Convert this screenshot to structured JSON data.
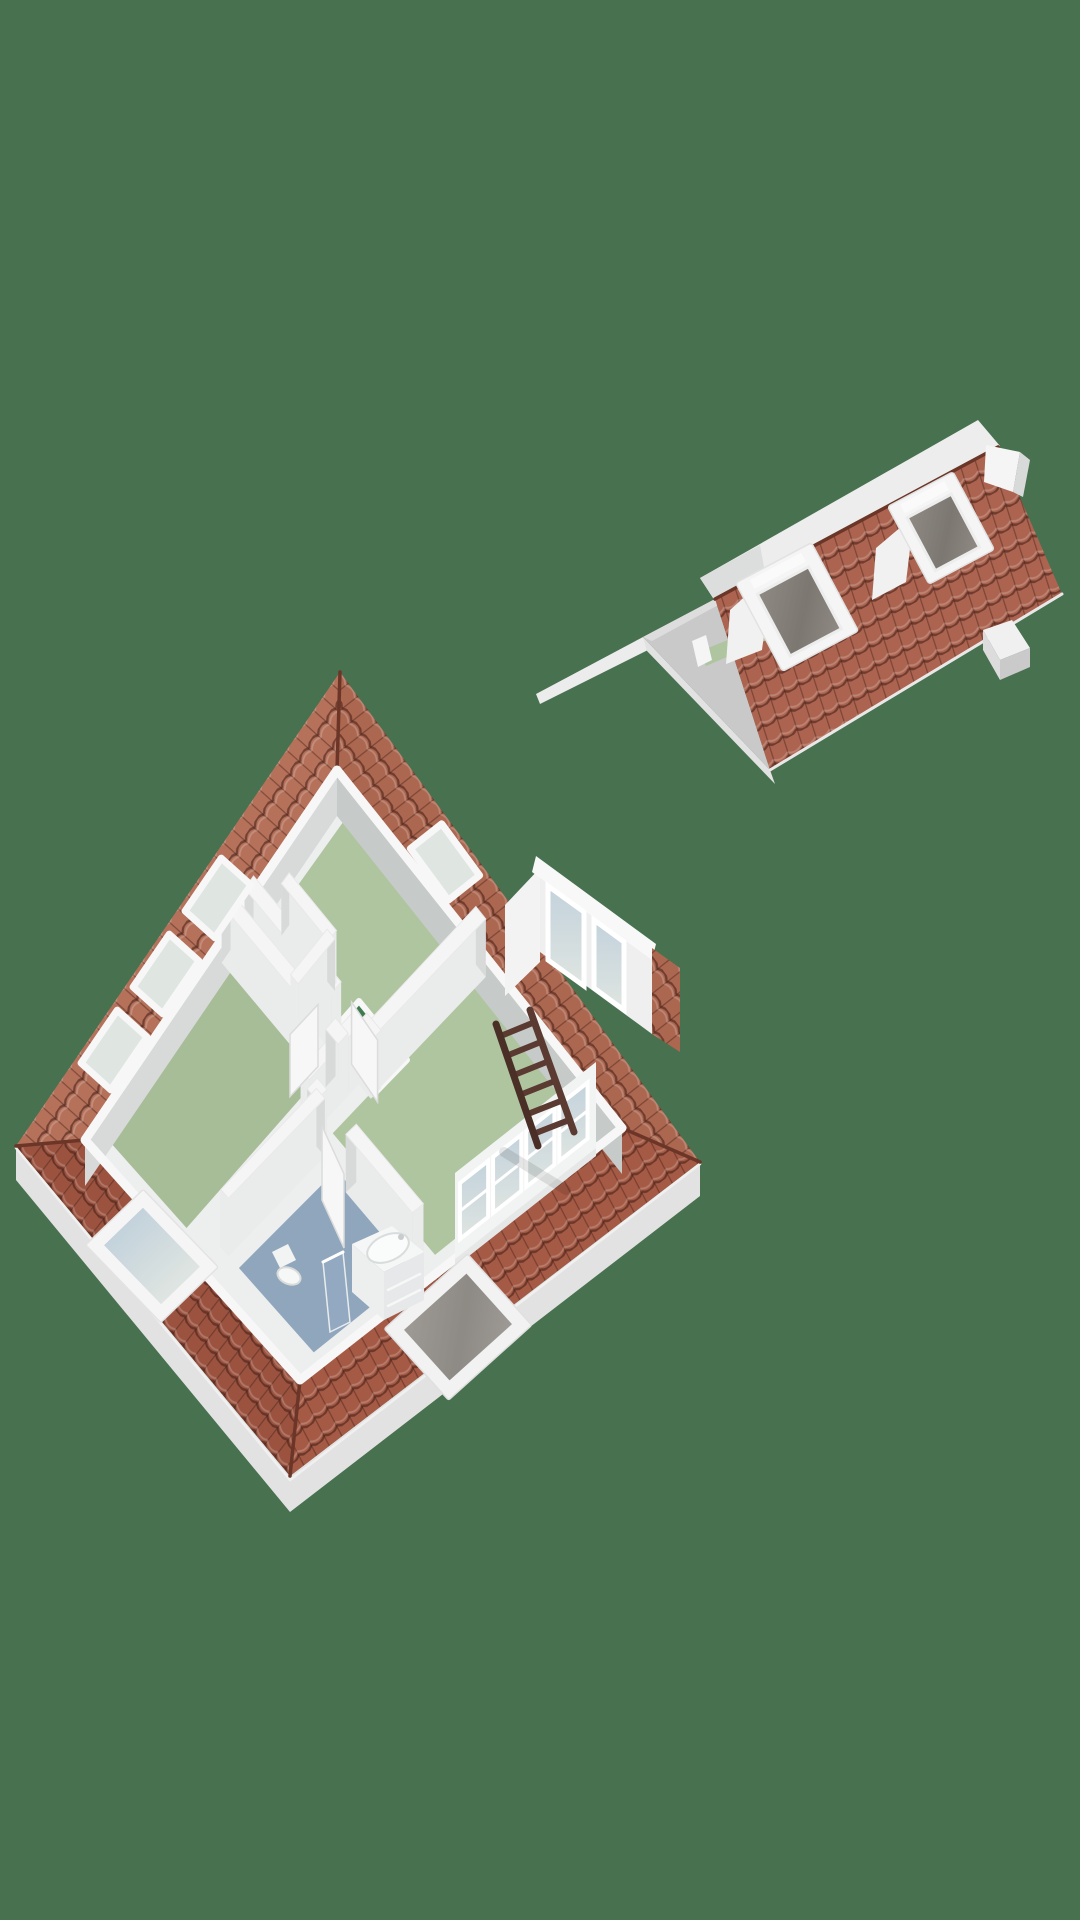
{
  "scene": {
    "type": "3d-floor-plan-render",
    "description": "Isometric 3D render of an attic storey floor plan (bottom left) and a detached roof section segment (top right) on a plain green background. No text labels are visible.",
    "floor_plan": {
      "label": "attic-floor-model",
      "rooms": [
        {
          "id": "bedroom-top",
          "floor": "green"
        },
        {
          "id": "bedroom-right-large",
          "floor": "green"
        },
        {
          "id": "bedroom-left",
          "floor": "green"
        },
        {
          "id": "bathroom",
          "floor": "blue"
        },
        {
          "id": "closet",
          "floor": "blue"
        },
        {
          "id": "landing-hall",
          "floor": "white"
        },
        {
          "id": "stair-opening",
          "floor": "dark-green"
        }
      ],
      "furniture": [
        "wooden-loft-ladder",
        "vanity-with-basin",
        "toilet",
        "shower-screen"
      ],
      "features": [
        "perimeter-roof-tile-bands",
        "knee-walls",
        "skylights",
        "side-dormer-with-windows",
        "window-band",
        "leaning-roof-window",
        "open-doors"
      ],
      "skylight_count": 4,
      "dormer_window_count": 2,
      "window_band_pane_count": 4
    },
    "roof_section": {
      "label": "roof-segment-model",
      "features": [
        "tiled-roof-plane",
        "ridge",
        "gable-hip-face",
        "green-floor-strip",
        "roof-window-left",
        "roof-window-right",
        "chimney-box",
        "end-wall"
      ]
    }
  },
  "colors": {
    "background": "#47714F",
    "tileNW": "#B5715A",
    "tileNE": "#AC6750",
    "tileSW": "#9B5340",
    "tileSE": "#A55A45",
    "tileRoof": "#AC6450",
    "tileLine": "rgba(62,28,20,0.55)",
    "tileRib": "rgba(70,32,22,0.45)",
    "tileHi": "rgba(255,255,255,0.20)",
    "ridgeCap": "#6B3628",
    "slab": "#E2E2E2",
    "slabLight": "#ECECEC",
    "wallWhite": "#F5F5F5",
    "wallFaceLight": "#EAEBEB",
    "wallFace": "#D8DADA",
    "wallDark": "#C6CAC9",
    "kneeWhite": "#F7F7F7",
    "grayGable": "#C9C9C9",
    "backSlope": "#ECEDEC",
    "floorGreen": "#AFC5A0",
    "floorGreenDeep": "#A6BD97",
    "hallFloor": "#EDEEEE",
    "bathBlue": "#8FA6BC",
    "voidGreen": "#3E7B51",
    "glass": "#DFE5E1",
    "glassBlue": "#C3D2DC",
    "screenGray": "#8F8A84",
    "screenGrayDark": "#7C7771",
    "ladder": "#5B3B31",
    "ladderDark": "#4A2F27",
    "shadow": "rgba(0,0,0,0.10)"
  }
}
